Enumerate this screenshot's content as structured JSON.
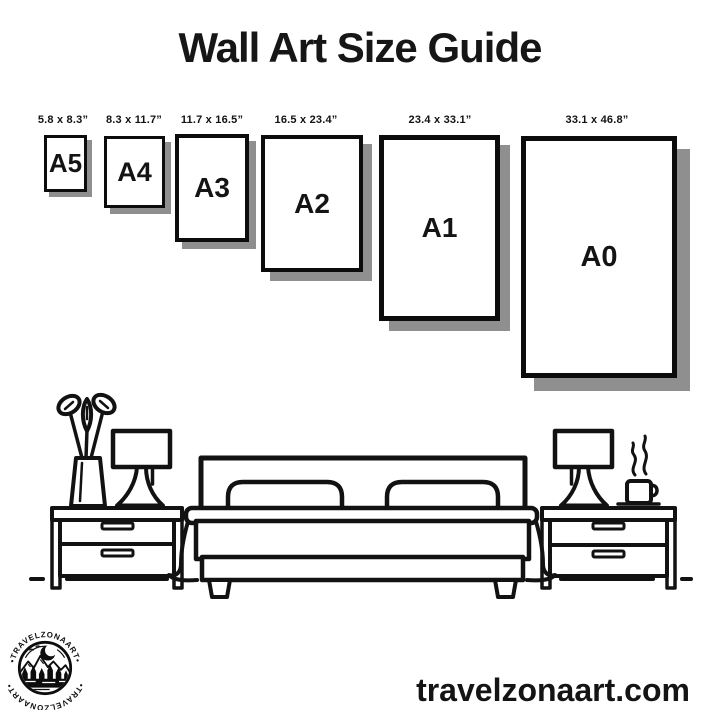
{
  "title": "Wall Art Size Guide",
  "sizes": [
    {
      "name": "A5",
      "dimensions": "5.8 x 8.3”"
    },
    {
      "name": "A4",
      "dimensions": "8.3 x 11.7”"
    },
    {
      "name": "A3",
      "dimensions": "11.7 x 16.5”"
    },
    {
      "name": "A2",
      "dimensions": "16.5 x 23.4”"
    },
    {
      "name": "A1",
      "dimensions": "23.4 x 33.1”"
    },
    {
      "name": "A0",
      "dimensions": "33.1 x 46.8”"
    }
  ],
  "logo": {
    "brand": "TravelZonaArt",
    "arc_text_top": "•TRAVELZONAART•",
    "arc_text_bottom": "•TRAVELZONAART•"
  },
  "footer": {
    "website": "travelzonaart.com"
  },
  "illustration": {
    "description": "black line-art bedroom scene",
    "elements": [
      "flower-vase",
      "table-lamp-left",
      "nightstand-left",
      "double-bed-with-two-pillows",
      "table-lamp-right",
      "steaming-coffee-cup",
      "nightstand-right",
      "floor-lines"
    ]
  },
  "colors": {
    "ink": "#121212",
    "frame_border": "#0c0c0c",
    "shadow": "#8f8f8f",
    "background": "#ffffff"
  }
}
